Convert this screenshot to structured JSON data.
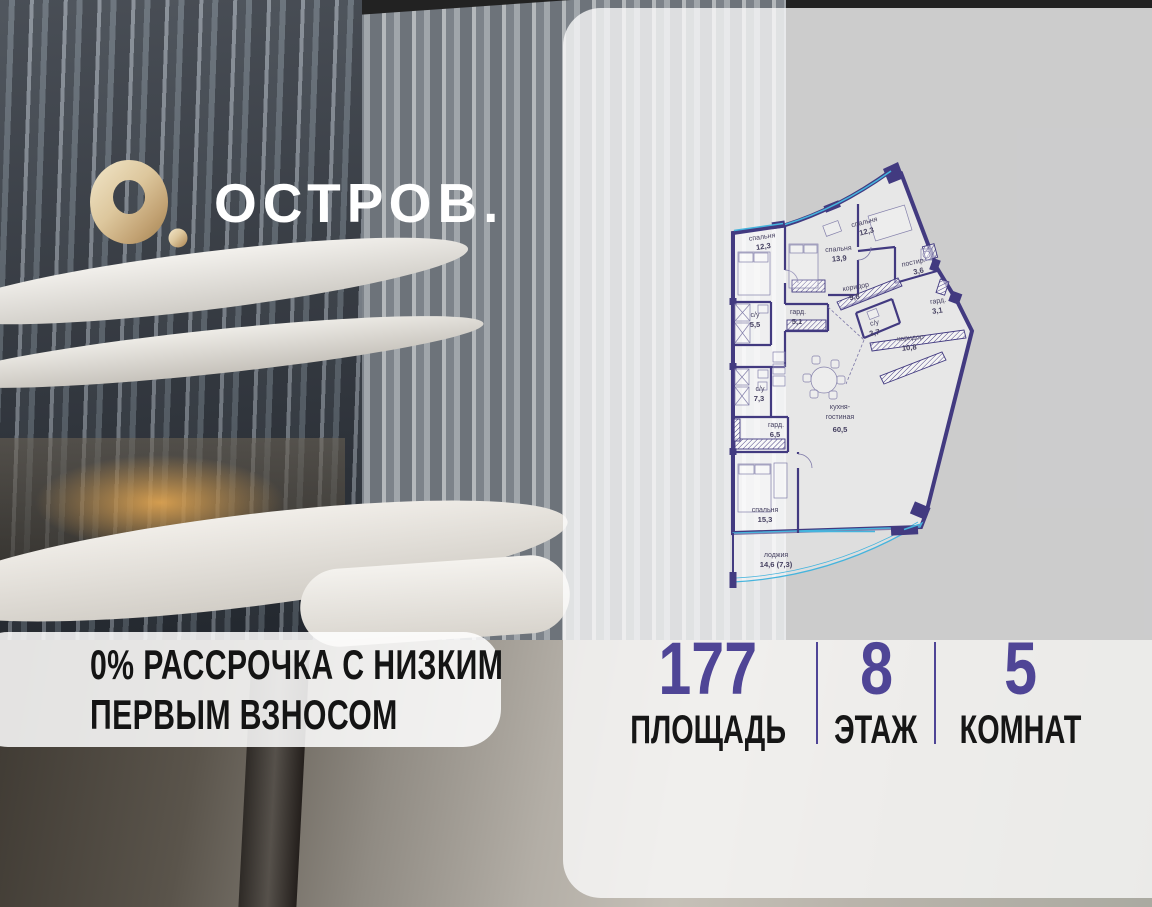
{
  "brand": {
    "name": "ОСТРОВ."
  },
  "promo": {
    "line1": "0% РАССРОЧКА С НИЗКИМ",
    "line2": "ПЕРВЫМ ВЗНОСОМ"
  },
  "stats": {
    "area": {
      "value": "177",
      "label": "ПЛОЩАДЬ"
    },
    "floor": {
      "value": "8",
      "label": "ЭТАЖ"
    },
    "rooms": {
      "value": "5",
      "label": "КОМНАТ"
    }
  },
  "plan": {
    "rooms": [
      {
        "name": "спальня",
        "area": "12,3"
      },
      {
        "name": "спальня",
        "area": "13,9"
      },
      {
        "name": "спальня",
        "area": "12,3"
      },
      {
        "name": "постир.",
        "area": "3,6"
      },
      {
        "name": "коридор",
        "area": "9,8"
      },
      {
        "name": "гард.",
        "area": "3,1"
      },
      {
        "name": "с/у",
        "area": "5,5"
      },
      {
        "name": "гард.",
        "area": "5,1"
      },
      {
        "name": "с/у",
        "area": "3,7"
      },
      {
        "name": "коридор",
        "area": "10,8"
      },
      {
        "name": "с/у",
        "area": "7,3"
      },
      {
        "name": "гард.",
        "area": "6,5"
      },
      {
        "name": "кухня-",
        "name2": "гостиная",
        "area": "60,5"
      },
      {
        "name": "спальня",
        "area": "15,3"
      },
      {
        "name": "лоджия",
        "area": "14,6 (7,3)"
      }
    ]
  },
  "colors": {
    "accent_purple": "#4f4596",
    "wall_indigo": "#423a80",
    "window_blue": "#45b4dd",
    "logo_gold": "#d9c39a"
  }
}
